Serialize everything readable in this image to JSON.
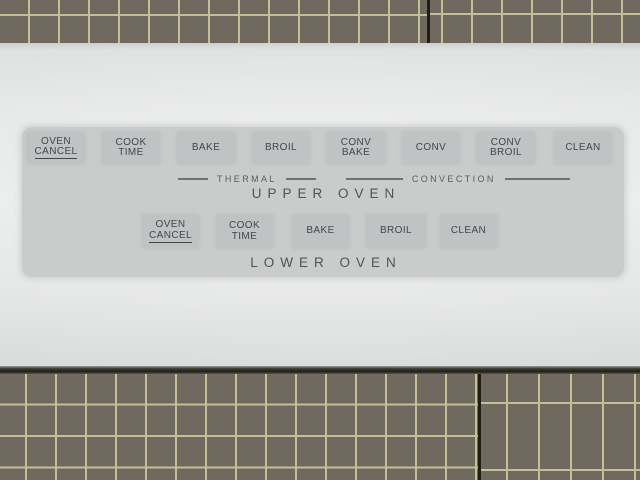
{
  "upper_oven": {
    "label": "UPPER OVEN",
    "thermal_label": "THERMAL",
    "convection_label": "CONVECTION",
    "buttons": [
      {
        "lines": [
          "OVEN",
          "CANCEL"
        ],
        "underline_line": 1
      },
      {
        "lines": [
          "COOK",
          "TIME"
        ]
      },
      {
        "lines": [
          "BAKE"
        ]
      },
      {
        "lines": [
          "BROIL"
        ]
      },
      {
        "lines": [
          "CONV",
          "BAKE"
        ]
      },
      {
        "lines": [
          "CONV"
        ]
      },
      {
        "lines": [
          "CONV",
          "BROIL"
        ]
      },
      {
        "lines": [
          "CLEAN"
        ]
      }
    ]
  },
  "lower_oven": {
    "label": "LOWER OVEN",
    "buttons": [
      {
        "lines": [
          "OVEN",
          "CANCEL"
        ],
        "underline_line": 1
      },
      {
        "lines": [
          "COOK",
          "TIME"
        ]
      },
      {
        "lines": [
          "BAKE"
        ]
      },
      {
        "lines": [
          "BROIL"
        ]
      },
      {
        "lines": [
          "CLEAN"
        ]
      }
    ]
  },
  "colors": {
    "mat_base": "#6f695e",
    "mat_grid_line": "#c4c096",
    "mat_seam": "#1f1d18",
    "panel_white": "#e7e9e8",
    "overlay_gray": "#c9cccb",
    "button_gray": "#bfc3c3",
    "label_text": "#42474a"
  }
}
